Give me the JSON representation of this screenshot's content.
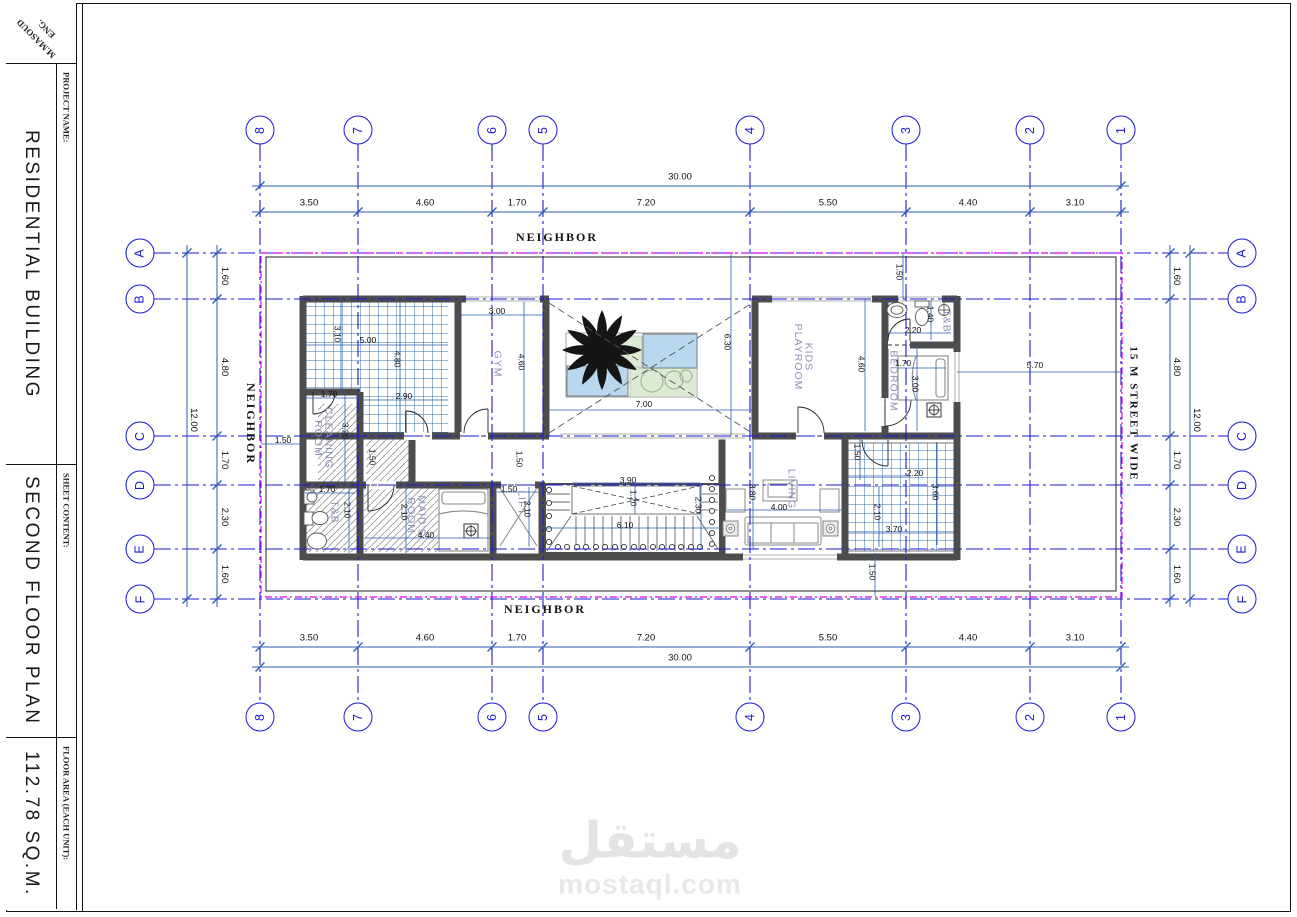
{
  "stamp": {
    "eng": "ENG.",
    "name": "M.MASOUD"
  },
  "title_block": {
    "project_label": "PROJECT NAME:",
    "project_value": "RESIDENTIAL BUILDING",
    "sheet_label": "SHEET CONTENT:",
    "sheet_value": "SECOND FLOOR PLAN",
    "area_label": "FLOOR AREA (EACH UNIT):",
    "area_value": "112.78 SQ.M."
  },
  "grid": {
    "cols": [
      "8",
      "7",
      "6",
      "5",
      "4",
      "3",
      "2",
      "1"
    ],
    "rows": [
      "A",
      "B",
      "C",
      "D",
      "E",
      "F"
    ]
  },
  "perimeter_dims": {
    "h_segments": [
      "3.50",
      "4.60",
      "1.70",
      "7.20",
      "5.50",
      "4.40",
      "3.10"
    ],
    "h_total": "30.00",
    "v_segments": [
      "1.60",
      "4.80",
      "1.70",
      "2.30",
      "1.60"
    ],
    "v_total": "12.00"
  },
  "surroundings": {
    "top": "NEIGHBOR",
    "bottom": "NEIGHBOR",
    "left": "NEIGHBOR",
    "street": "15 M STREET WIDE"
  },
  "rooms": {
    "gym": "GYM",
    "kids_playroom_1": "KIDS",
    "kids_playroom_2": "PLAYROOM",
    "bedroom": "BEDROOM",
    "toilet_top": "T&B",
    "cleaning_1": "CLEANING",
    "cleaning_2": "ROOM",
    "toilet_bottom": "T&B",
    "maids_1": "MAID'S",
    "maids_2": "ROOM",
    "lift": "LIFT",
    "living": "LIVING"
  },
  "interior_dims": {
    "terrace": {
      "w": "5.00",
      "w2": "2.90",
      "h": "4.80",
      "h2": "3.10"
    },
    "gym": {
      "w": "3.00",
      "h": "4.60"
    },
    "courtyard": {
      "w": "7.00",
      "h": "6.30"
    },
    "cleaning": {
      "w": "1.70",
      "h": "3.20"
    },
    "corridor": {
      "w": "1.50",
      "w2": "1.50"
    },
    "toilet_bottom": {
      "w": "1.70",
      "h": "2.10"
    },
    "maids": {
      "w": "4.40",
      "h": "2.10"
    },
    "lift": {
      "w": "1.50",
      "h": "2.10"
    },
    "stairs": {
      "w": "6.10",
      "h": "2.30",
      "void_w": "3.90",
      "void_h": "1.20"
    },
    "living": {
      "w": "4.00",
      "h": "3.80"
    },
    "toilet_top": {
      "w": "2.20",
      "h": "1.40"
    },
    "bedroom": {
      "h": "3.00",
      "bed_w": "1.70",
      "zone_h": "4.60"
    },
    "terrace_se": {
      "w": "3.70",
      "w2": "2.20",
      "h": "3.60",
      "h2": "2.10",
      "inset": "1.50"
    },
    "setbacks": {
      "left": "1.50",
      "top_right": "1.50",
      "bottom": "1.50",
      "street_side": "5.70"
    }
  },
  "watermark": {
    "logo": "مستقل",
    "site": "mostaql.com"
  }
}
